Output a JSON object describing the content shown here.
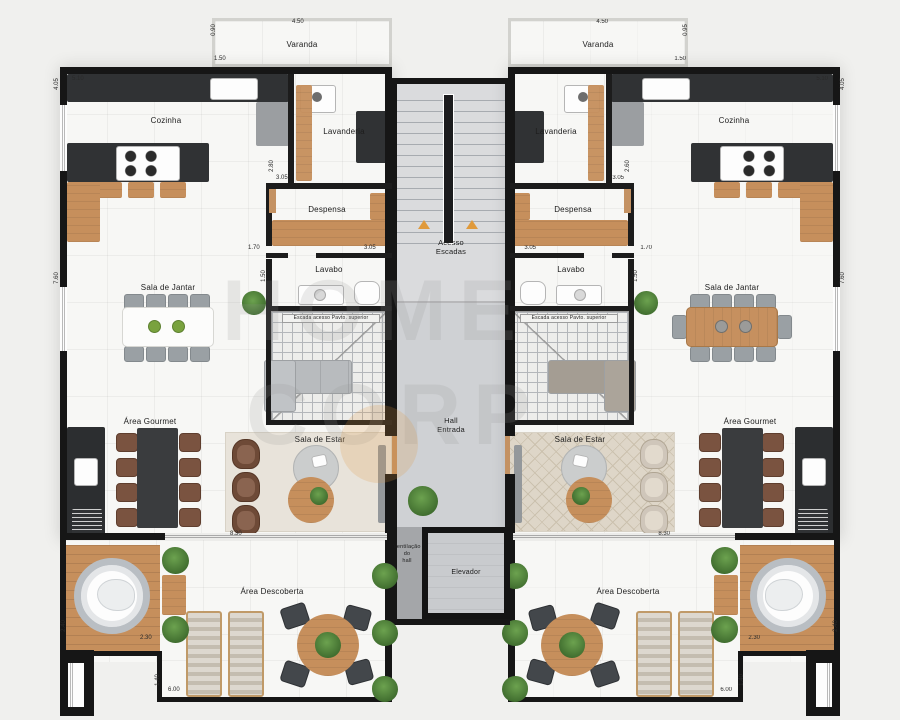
{
  "rooms": {
    "varanda": "Varanda",
    "cozinha": "Cozinha",
    "lavanderia": "Lavanderia",
    "despensa": "Despensa",
    "lavabo": "Lavabo",
    "sala_jantar": "Sala de Jantar",
    "area_gourmet": "Área Gourmet",
    "sala_estar": "Sala de Estar",
    "area_descoberta": "Área Descoberta",
    "escada_interna": "Escada acesso Pavto. superior"
  },
  "core": {
    "acesso_escadas": "Acesso\nEscadas",
    "hall_entrada": "Hall\nEntrada",
    "elevador": "Elevador",
    "ventilacao": "Ventilação\ndo\nhall"
  },
  "dimsL": {
    "varanda_w": "4.50",
    "varanda_side": "0.90",
    "varanda_depth": "1.50",
    "cozinha_w": "5.10",
    "wall_upper": "4.05",
    "wall_main": "7.60",
    "despensa_h": "2.80",
    "despensa_w": "3.05",
    "corredor_w": "1.70",
    "lavabo_w": "3.05",
    "lavabo_h": "1.50",
    "estar_w": "8.30",
    "deck_h": "2.40",
    "deck_w": "2.30",
    "terraco_h": "1.40",
    "terraco_w": "6.00"
  },
  "dimsR": {
    "varanda_w": "4.50",
    "varanda_side": "0.95",
    "varanda_depth": "1.50",
    "cozinha_w": "5.10",
    "wall_upper": "4.05",
    "wall_main": "7.60",
    "despensa_h": "2.60",
    "despensa_w": "3.05",
    "corredor_w": "1.70",
    "lavabo_w": "3.05",
    "lavabo_h": "1.50",
    "estar_w": "8.30",
    "deck_h": "2.40",
    "deck_w": "2.30",
    "terraco_h": "1.40",
    "terraco_w": "6.00"
  },
  "watermark": {
    "line1": "HOME",
    "line2": "CORP"
  },
  "colors": {
    "arrow_orange": "#e09a3c",
    "wood": "#c68f5c",
    "wall": "#161616"
  }
}
